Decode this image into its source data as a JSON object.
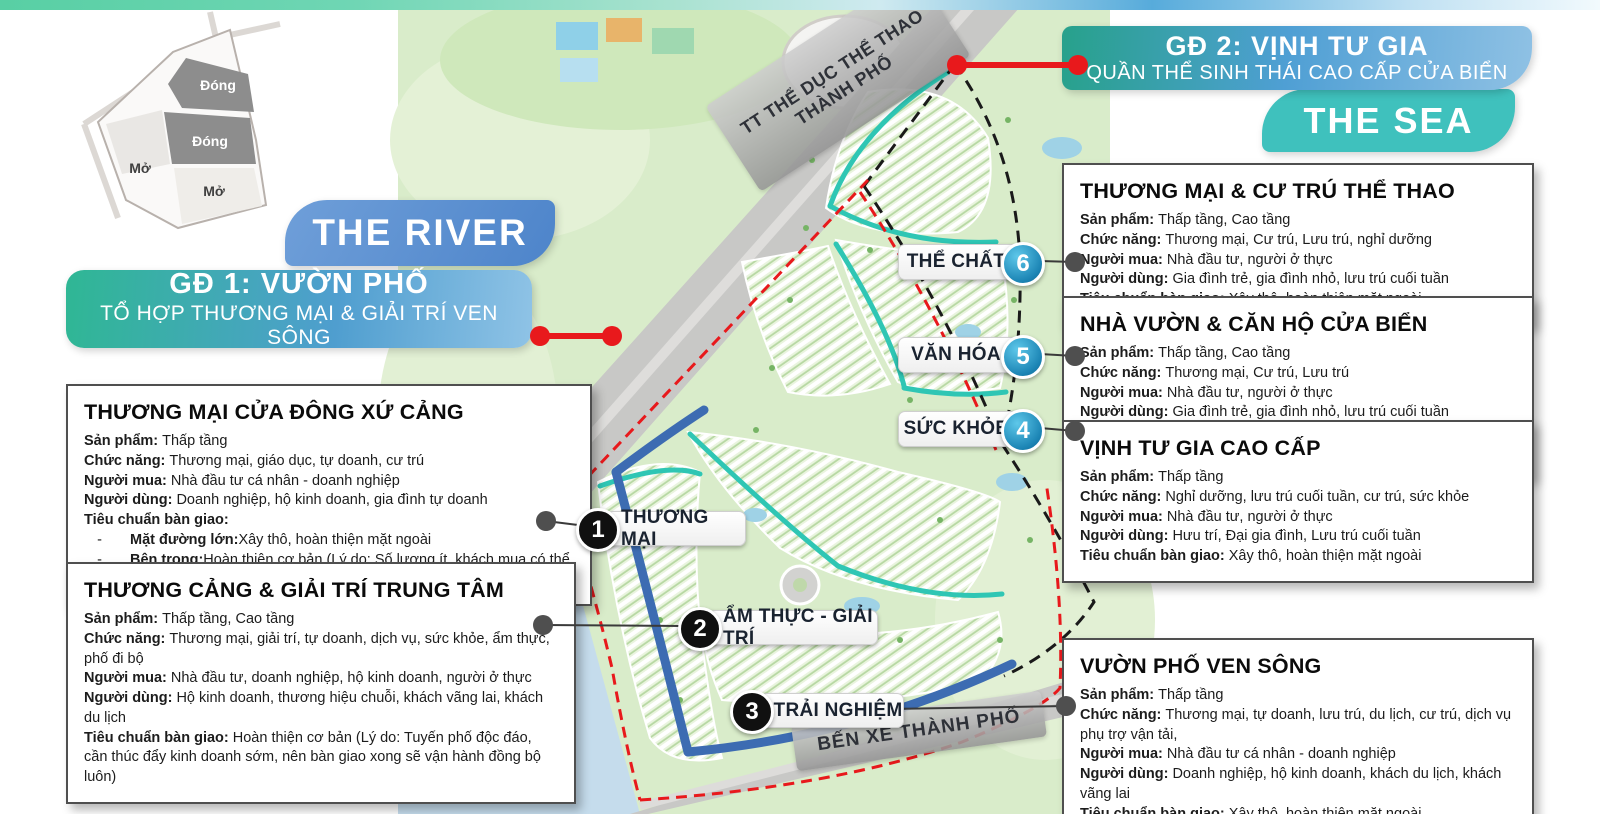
{
  "colors": {
    "accent_red": "#e8191c",
    "teal_sea": "#3fc1bd",
    "blue_river": "#5b8fd3",
    "phase_gradient_start": "#2fb794",
    "phase_gradient_end": "#4f9ecf",
    "map_green": "#d9ecca",
    "canal_teal": "#2fc6b4",
    "road_blue": "#3d6cb2"
  },
  "minimap": {
    "closed_1": "Đóng",
    "closed_2": "Đóng",
    "open_1": "Mở",
    "open_2": "Mở"
  },
  "banners": {
    "the_river": "THE RIVER",
    "the_sea": "THE SEA",
    "phase1": {
      "title": "GĐ 1: VƯỜN PHỐ",
      "subtitle": "TỔ HỢP THƯƠNG MẠI & GIẢI TRÍ VEN SÔNG"
    },
    "phase2": {
      "title": "GĐ 2: VỊNH TƯ GIA",
      "subtitle": "QUẦN THỂ SINH THÁI CAO CẤP CỬA BIỂN"
    }
  },
  "map": {
    "sport_center_line1": "TT THỂ DỤC THỂ THAO",
    "sport_center_line2": "THÀNH PHỐ",
    "bus_station": "BẾN XE THÀNH PHỐ"
  },
  "markers": [
    {
      "num": "1",
      "label": "THƯƠNG MẠI"
    },
    {
      "num": "2",
      "label": "ẨM THỰC - GIẢI TRÍ"
    },
    {
      "num": "3",
      "label": "TRẢI NGHIỆM"
    },
    {
      "num": "4",
      "label": "SỨC KHỎE"
    },
    {
      "num": "5",
      "label": "VĂN HÓA"
    },
    {
      "num": "6",
      "label": "THỂ CHẤT"
    }
  ],
  "info_boxes": [
    {
      "title": "THƯƠNG MẠI CỬA ĐÔNG XỨ CẢNG",
      "fields": [
        {
          "label": "Sản phẩm:",
          "text": "Thấp tầng"
        },
        {
          "label": "Chức năng:",
          "text": "Thương mại, giáo dục, tự doanh, cư trú"
        },
        {
          "label": "Người mua:",
          "text": "Nhà đầu tư cá nhân - doanh nghiệp"
        },
        {
          "label": "Người dùng:",
          "text": "Doanh nghiệp, hộ kinh doanh, gia đình tự doanh"
        },
        {
          "label": "Tiêu chuẩn bàn giao:",
          "text": ""
        }
      ],
      "sub_items": [
        {
          "label": "Mặt đường lớn:",
          "text": "Xây thô, hoàn thiện mặt ngoài"
        },
        {
          "label": "Bên trong:",
          "text": "Hoàn thiện cơ bản (Lý do: Số lượng ít, khách mua có thể cho thuê/khai thác ngay)"
        }
      ]
    },
    {
      "title": "THƯƠNG CẢNG & GIẢI TRÍ TRUNG TÂM",
      "fields": [
        {
          "label": "Sản phẩm:",
          "text": "Thấp tầng, Cao tầng"
        },
        {
          "label": "Chức năng:",
          "text": "Thương mại, giải trí, tự doanh, dịch vụ, sức khỏe, ẩm thực, phố đi bộ"
        },
        {
          "label": "Người mua:",
          "text": "Nhà đầu tư, doanh nghiệp, hộ kinh doanh, người ở thực"
        },
        {
          "label": "Người dùng:",
          "text": "Hộ kinh doanh, thương hiệu chuỗi, khách vãng lai, khách du lịch"
        },
        {
          "label": "Tiêu chuẩn bàn giao:",
          "text": "Hoàn thiện cơ bản (Lý do: Tuyến phố độc đáo, cần thúc đẩy kinh doanh sớm, nên bàn giao xong sẽ vận hành đồng bộ luôn)"
        }
      ]
    },
    {
      "title": "THƯƠNG MẠI & CƯ TRÚ THỂ THAO",
      "fields": [
        {
          "label": "Sản phẩm:",
          "text": "Thấp tầng, Cao tầng"
        },
        {
          "label": "Chức năng:",
          "text": "Thương mại, Cư trú, Lưu trú, nghỉ dưỡng"
        },
        {
          "label": "Người mua:",
          "text": "Nhà đầu tư, người ở thực"
        },
        {
          "label": "Người dùng:",
          "text": "Gia đình trẻ, gia đình nhỏ, lưu trú cuối tuần"
        },
        {
          "label": "Tiêu chuẩn bàn giao:",
          "text": "Xây thô, hoàn thiện mặt ngoài"
        }
      ]
    },
    {
      "title": "NHÀ VƯỜN & CĂN HỘ CỬA BIỂN",
      "fields": [
        {
          "label": "Sản phẩm:",
          "text": "Thấp tầng, Cao tầng"
        },
        {
          "label": "Chức năng:",
          "text": "Thương mại, Cư trú, Lưu trú"
        },
        {
          "label": "Người mua:",
          "text": "Nhà đầu tư, người ở thực"
        },
        {
          "label": "Người dùng:",
          "text": "Gia đình trẻ, gia đình nhỏ, lưu trú cuối tuần"
        },
        {
          "label": "Tiêu chuẩn bàn giao:",
          "text": "Hoàn thiện cơ bản (Lý do: Số lượng ít, khách mua có thể cho thuê/khai thác ngay)"
        }
      ]
    },
    {
      "title": "VỊNH TƯ GIA CAO CẤP",
      "fields": [
        {
          "label": "Sản phẩm:",
          "text": "Thấp tầng"
        },
        {
          "label": "Chức năng:",
          "text": "Nghỉ dưỡng, lưu trú cuối tuần, cư trú, sức khỏe"
        },
        {
          "label": "Người mua:",
          "text": "Nhà đầu tư, người ở thực"
        },
        {
          "label": "Người dùng:",
          "text": "Hưu trí, Đại gia đình, Lưu trú cuối tuần"
        },
        {
          "label": "Tiêu chuẩn bàn giao:",
          "text": "Xây thô, hoàn thiện mặt ngoài"
        }
      ]
    },
    {
      "title": "VƯỜN PHỐ VEN SÔNG",
      "fields": [
        {
          "label": "Sản phẩm:",
          "text": "Thấp tầng"
        },
        {
          "label": "Chức năng:",
          "text": "Thương mại, tự doanh, lưu trú, du lịch, cư trú, dịch vụ phụ trợ vận tải,"
        },
        {
          "label": "Người mua:",
          "text": "Nhà đầu tư cá nhân - doanh nghiệp"
        },
        {
          "label": "Người dùng:",
          "text": "Doanh nghiệp, hộ kinh doanh, khách du lịch, khách vãng lai"
        },
        {
          "label": "Tiêu chuẩn bàn giao:",
          "text": "Xây thô, hoàn thiện mặt ngoài"
        }
      ]
    }
  ]
}
